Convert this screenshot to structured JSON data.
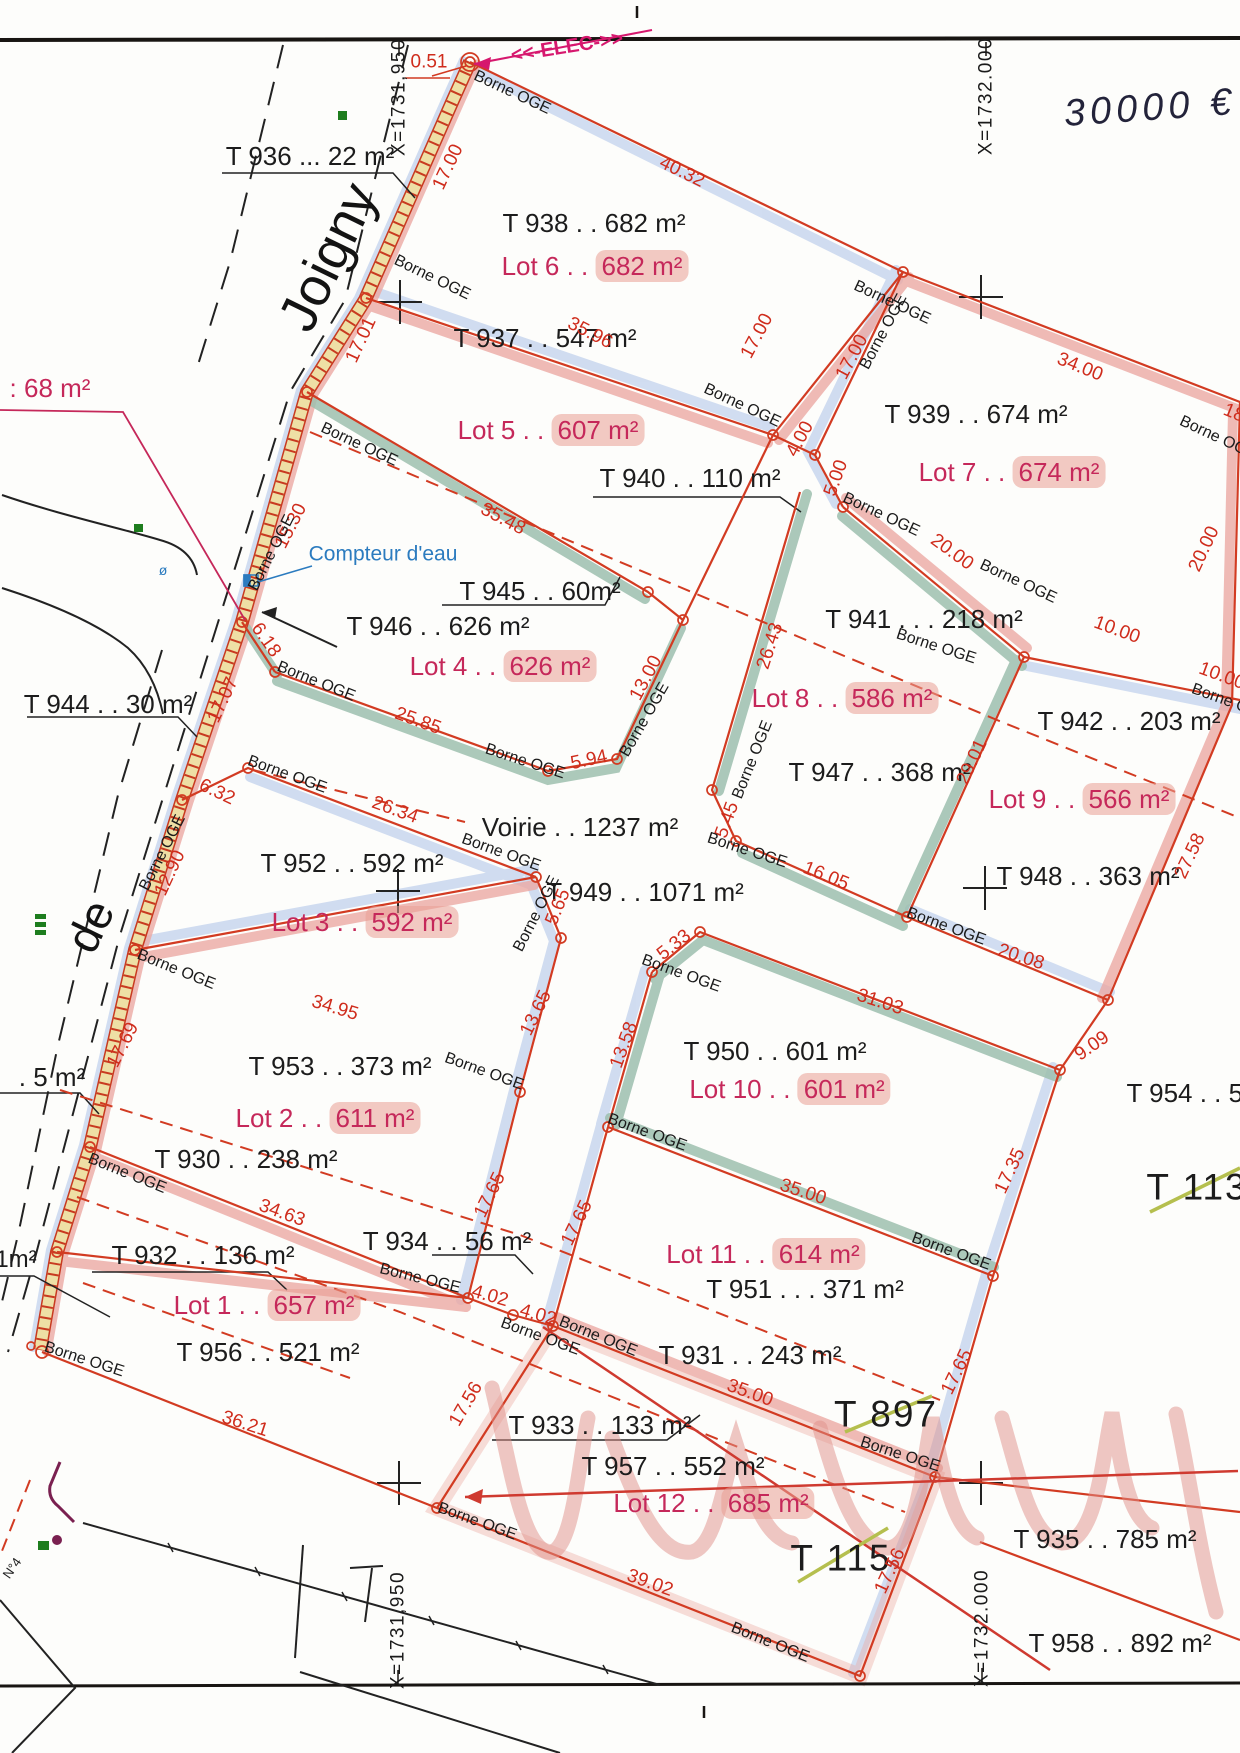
{
  "map": {
    "type": "cadastral subdivision plan",
    "colors": {
      "boundary_red": "#d23b22",
      "measure_red": "#cf2c1c",
      "lot_crimson": "#c5285a",
      "highlight_pink": "#e99e94",
      "band_blue": "#c9d7ef",
      "band_pink": "#eba9a4",
      "band_teal": "#9dbfae",
      "strip_yellow": "#eedfa5",
      "note_blue": "#2b7bbf",
      "elec_magenta": "#d6186e",
      "strike_green": "#b5bf4e",
      "ink_black": "#1c1c1c"
    },
    "borne_marker_text": "Borne OGE"
  },
  "label_groups": [
    {
      "name": "parcel-labels",
      "style": "parcel",
      "items": [
        {
          "n": "T936",
          "t": "T 936 ... 22 m²",
          "x": 310,
          "y": 156
        },
        {
          "n": "T938",
          "t": "T 938  . . 682 m²",
          "x": 594,
          "y": 223
        },
        {
          "n": "T937",
          "t": "T 937 . . 547 m²",
          "x": 545,
          "y": 338
        },
        {
          "n": "T940",
          "t": "T 940 . . 110 m²",
          "x": 690,
          "y": 478
        },
        {
          "n": "T939",
          "t": "T 939 . . 674 m²",
          "x": 976,
          "y": 414
        },
        {
          "n": "T941",
          "t": "T 941 . . . 218 m²",
          "x": 924,
          "y": 619
        },
        {
          "n": "T942",
          "t": "T 942 . . 203 m²",
          "x": 1129,
          "y": 721
        },
        {
          "n": "T947",
          "t": "T 947 . . 368 m²",
          "x": 880,
          "y": 772
        },
        {
          "n": "T948",
          "t": "T 948 . .  363 m²",
          "x": 1088,
          "y": 876
        },
        {
          "n": "T946",
          "t": "T 946 . . 626 m²",
          "x": 438,
          "y": 626
        },
        {
          "n": "T945",
          "t": "T 945 . . 60m²",
          "x": 540,
          "y": 591
        },
        {
          "n": "T944",
          "t": "T 944 . . 30 m²",
          "x": 108,
          "y": 704
        },
        {
          "n": "VOIRIE",
          "t": "Voirie . . 1237 m²",
          "x": 580,
          "y": 827
        },
        {
          "n": "T949",
          "t": "T 949 . .  1071 m²",
          "x": 645,
          "y": 892
        },
        {
          "n": "T952",
          "t": "T 952 . . 592 m²",
          "x": 352,
          "y": 863
        },
        {
          "n": "T953",
          "t": "T 953 . .  373 m²",
          "x": 340,
          "y": 1066
        },
        {
          "n": "T930",
          "t": "T 930 . . 238 m²",
          "x": 246,
          "y": 1159
        },
        {
          "n": "T934",
          "t": "T 934 . . 56 m²",
          "x": 447,
          "y": 1241
        },
        {
          "n": "T932",
          "t": "T 932 . . 136 m²",
          "x": 203,
          "y": 1255
        },
        {
          "n": "T956",
          "t": "T 956 . . 521 m²",
          "x": 268,
          "y": 1352
        },
        {
          "n": "T950",
          "t": "T 950 . . 601 m²",
          "x": 775,
          "y": 1051
        },
        {
          "n": "T951",
          "t": "T 951 . . .  371 m²",
          "x": 805,
          "y": 1289
        },
        {
          "n": "T931",
          "t": "T 931 . . 243 m²",
          "x": 750,
          "y": 1355
        },
        {
          "n": "T933",
          "t": "T 933 . . 133 m²",
          "x": 600,
          "y": 1425
        },
        {
          "n": "T957",
          "t": "T 957 . . 552 m²",
          "x": 673,
          "y": 1466
        },
        {
          "n": "T935",
          "t": "T 935 . . 785 m²",
          "x": 1105,
          "y": 1539
        },
        {
          "n": "T958",
          "t": "T 958 . . 892 m²",
          "x": 1120,
          "y": 1643
        },
        {
          "n": "T954",
          "t": "T 954 . . 58",
          "x": 1192,
          "y": 1093
        }
      ]
    },
    {
      "name": "parcel-labels-large",
      "style": "parcel-big",
      "items": [
        {
          "n": "T897",
          "t": "T 897",
          "x": 886,
          "y": 1414
        },
        {
          "n": "T113",
          "t": "T 113",
          "x": 1197,
          "y": 1187
        },
        {
          "n": "T115",
          "t": "T 115",
          "x": 841,
          "y": 1558
        }
      ]
    },
    {
      "name": "lot-labels",
      "style": "lot",
      "items": [
        {
          "n": "lot-6",
          "prefix": "Lot  6 . .",
          "area": "682 m²",
          "x": 595,
          "y": 266
        },
        {
          "n": "lot-5",
          "prefix": "Lot  5 . .",
          "area": "607 m²",
          "x": 551,
          "y": 430
        },
        {
          "n": "lot-7",
          "prefix": "Lot  7 . .",
          "area": "674 m²",
          "x": 1012,
          "y": 472
        },
        {
          "n": "lot-4",
          "prefix": "Lot  4 . .",
          "area": "626 m²",
          "x": 503,
          "y": 666
        },
        {
          "n": "lot-8",
          "prefix": "Lot  8 . .",
          "area": "586 m²",
          "x": 845,
          "y": 698
        },
        {
          "n": "lot-9",
          "prefix": "Lot  9 . .",
          "area": "566 m²",
          "x": 1082,
          "y": 799
        },
        {
          "n": "lot-3",
          "prefix": "Lot  3 . .",
          "area": "592 m²",
          "x": 365,
          "y": 922
        },
        {
          "n": "lot-2",
          "prefix": "Lot  2 . .",
          "area": "611 m²",
          "x": 328,
          "y": 1118
        },
        {
          "n": "lot-10",
          "prefix": "Lot 10 . .",
          "area": "601 m²",
          "x": 790,
          "y": 1089
        },
        {
          "n": "lot-11",
          "prefix": "Lot 11 . .",
          "area": "614 m²",
          "x": 766,
          "y": 1254
        },
        {
          "n": "lot-1",
          "prefix": "Lot  1 . .",
          "area": "657 m²",
          "x": 267,
          "y": 1305
        },
        {
          "n": "lot-12",
          "prefix": "Lot 12 . .",
          "area": "685 m²",
          "x": 714,
          "y": 1503
        }
      ]
    },
    {
      "name": "measurement-labels",
      "style": "measure",
      "items": [
        {
          "t": "0.51",
          "x": 429,
          "y": 62
        },
        {
          "t": "17.00",
          "x": 448,
          "y": 167,
          "r": -65
        },
        {
          "t": "17.01",
          "x": 361,
          "y": 340,
          "r": -65
        },
        {
          "t": "15.30",
          "x": 291,
          "y": 526,
          "r": -63
        },
        {
          "t": "6.18",
          "x": 266,
          "y": 640,
          "r": 55
        },
        {
          "t": "17.07",
          "x": 223,
          "y": 700,
          "r": -65
        },
        {
          "t": "6.32",
          "x": 217,
          "y": 792,
          "r": 25
        },
        {
          "t": "12.90",
          "x": 170,
          "y": 873,
          "r": -65
        },
        {
          "t": "26.34",
          "x": 395,
          "y": 810,
          "r": 20
        },
        {
          "t": "25.85",
          "x": 418,
          "y": 721,
          "r": 20
        },
        {
          "t": "35.48",
          "x": 503,
          "y": 519,
          "r": 28
        },
        {
          "t": "5.94",
          "x": 589,
          "y": 760,
          "r": -12
        },
        {
          "t": "13.00",
          "x": 646,
          "y": 678,
          "r": -62
        },
        {
          "t": "26.43",
          "x": 770,
          "y": 646,
          "r": -72
        },
        {
          "t": "5.45",
          "x": 727,
          "y": 820,
          "r": -70
        },
        {
          "t": "5.65",
          "x": 558,
          "y": 907,
          "r": -68
        },
        {
          "t": "13.65",
          "x": 536,
          "y": 1013,
          "r": -64
        },
        {
          "t": "5.33",
          "x": 674,
          "y": 945,
          "r": -38
        },
        {
          "t": "16.05",
          "x": 826,
          "y": 876,
          "r": 22
        },
        {
          "t": "20.00",
          "x": 952,
          "y": 552,
          "r": 36
        },
        {
          "t": "20.00",
          "x": 1204,
          "y": 549,
          "r": -65
        },
        {
          "t": "10.00",
          "x": 1117,
          "y": 630,
          "r": 20
        },
        {
          "t": "10.00",
          "x": 1222,
          "y": 676,
          "r": 20
        },
        {
          "t": "34.00",
          "x": 1080,
          "y": 367,
          "r": 22
        },
        {
          "t": "18",
          "x": 1234,
          "y": 413,
          "r": 22
        },
        {
          "t": "5.00",
          "x": 836,
          "y": 478,
          "r": -70
        },
        {
          "t": "4.00",
          "x": 800,
          "y": 439,
          "r": -62
        },
        {
          "t": "17.00",
          "x": 757,
          "y": 336,
          "r": -62
        },
        {
          "t": "17.00",
          "x": 852,
          "y": 357,
          "r": -62
        },
        {
          "t": "40.32",
          "x": 682,
          "y": 172,
          "r": 26
        },
        {
          "t": "35.96",
          "x": 590,
          "y": 333,
          "r": 27
        },
        {
          "t": "34.95",
          "x": 335,
          "y": 1008,
          "r": 17
        },
        {
          "t": "17.69",
          "x": 123,
          "y": 1045,
          "r": -63
        },
        {
          "t": "17.65",
          "x": 490,
          "y": 1195,
          "r": -64
        },
        {
          "t": "17.65",
          "x": 577,
          "y": 1223,
          "r": -64
        },
        {
          "t": "17.65",
          "x": 957,
          "y": 1372,
          "r": -64
        },
        {
          "t": "13.58",
          "x": 624,
          "y": 1045,
          "r": -70
        },
        {
          "t": "31.03",
          "x": 880,
          "y": 1002,
          "r": 18
        },
        {
          "t": "9.09",
          "x": 1092,
          "y": 1046,
          "r": -35
        },
        {
          "t": "20.08",
          "x": 1021,
          "y": 957,
          "r": 18
        },
        {
          "t": "27.58",
          "x": 1190,
          "y": 856,
          "r": -65
        },
        {
          "t": "29.01",
          "x": 972,
          "y": 762,
          "r": -65
        },
        {
          "t": "17.35",
          "x": 1010,
          "y": 1171,
          "r": -65
        },
        {
          "t": "35.00",
          "x": 803,
          "y": 1192,
          "r": 18
        },
        {
          "t": "35.00",
          "x": 750,
          "y": 1393,
          "r": 20
        },
        {
          "t": "4.02",
          "x": 490,
          "y": 1296,
          "r": 16
        },
        {
          "t": "4.02",
          "x": 538,
          "y": 1315,
          "r": 16
        },
        {
          "t": "17.56",
          "x": 466,
          "y": 1404,
          "r": -60
        },
        {
          "t": "17.56",
          "x": 890,
          "y": 1571,
          "r": -65
        },
        {
          "t": "39.02",
          "x": 650,
          "y": 1583,
          "r": 20
        },
        {
          "t": "36.21",
          "x": 245,
          "y": 1424,
          "r": 18
        },
        {
          "t": "34.63",
          "x": 282,
          "y": 1213,
          "r": 20
        }
      ]
    },
    {
      "name": "borne-labels",
      "style": "borne",
      "default_text": "Borne OGE",
      "items": [
        {
          "x": 512,
          "y": 93,
          "r": 25
        },
        {
          "x": 892,
          "y": 303,
          "r": 25
        },
        {
          "x": 884,
          "y": 332,
          "r": -62
        },
        {
          "x": 432,
          "y": 278,
          "r": 26
        },
        {
          "x": 742,
          "y": 406,
          "r": 25
        },
        {
          "x": 359,
          "y": 445,
          "r": 25
        },
        {
          "x": 272,
          "y": 553,
          "r": -63
        },
        {
          "x": 316,
          "y": 682,
          "r": 22
        },
        {
          "x": 287,
          "y": 775,
          "r": 20
        },
        {
          "x": 163,
          "y": 853,
          "r": -63
        },
        {
          "x": 525,
          "y": 762,
          "r": 18
        },
        {
          "x": 645,
          "y": 720,
          "r": -60
        },
        {
          "x": 501,
          "y": 853,
          "r": 20
        },
        {
          "x": 537,
          "y": 914,
          "r": -63
        },
        {
          "x": 747,
          "y": 851,
          "r": 18
        },
        {
          "x": 753,
          "y": 760,
          "r": -68
        },
        {
          "x": 881,
          "y": 515,
          "r": 25
        },
        {
          "x": 1018,
          "y": 582,
          "r": 25
        },
        {
          "x": 936,
          "y": 647,
          "r": 18
        },
        {
          "t": "Borne O",
          "x": 1220,
          "y": 699,
          "r": 20
        },
        {
          "t": "Borne OG",
          "x": 1213,
          "y": 436,
          "r": 25
        },
        {
          "x": 946,
          "y": 927,
          "r": 20
        },
        {
          "x": 176,
          "y": 970,
          "r": 22
        },
        {
          "x": 127,
          "y": 1174,
          "r": 22
        },
        {
          "x": 484,
          "y": 1072,
          "r": 20
        },
        {
          "x": 681,
          "y": 974,
          "r": 20
        },
        {
          "x": 647,
          "y": 1133,
          "r": 20
        },
        {
          "x": 951,
          "y": 1252,
          "r": 20
        },
        {
          "x": 84,
          "y": 1360,
          "r": 18
        },
        {
          "x": 420,
          "y": 1279,
          "r": 14
        },
        {
          "x": 540,
          "y": 1337,
          "r": 20
        },
        {
          "x": 598,
          "y": 1337,
          "r": 22
        },
        {
          "x": 477,
          "y": 1522,
          "r": 20
        },
        {
          "x": 770,
          "y": 1643,
          "r": 22
        },
        {
          "x": 900,
          "y": 1455,
          "r": 18
        }
      ]
    },
    {
      "name": "coordinate-labels",
      "style": "coord",
      "items": [
        {
          "t": "X=1731,950",
          "x": 399,
          "y": 97,
          "r": -90
        },
        {
          "t": "X=1732.000",
          "x": 986,
          "y": 96,
          "r": -90
        },
        {
          "t": "X=1731,950",
          "x": 398,
          "y": 1630,
          "r": -90
        },
        {
          "t": "X=1732.000",
          "x": 982,
          "y": 1628,
          "r": -90
        }
      ]
    },
    {
      "name": "street-labels",
      "style": "street",
      "items": [
        {
          "n": "street-joigny",
          "t": "Joigny",
          "x": 328,
          "y": 257,
          "r": -64,
          "fs": 54
        },
        {
          "n": "street-de",
          "t": "de",
          "x": 90,
          "y": 926,
          "r": -64,
          "fs": 46
        }
      ]
    },
    {
      "name": "misc-labels",
      "style": "misc",
      "items": [
        {
          "n": "area-68",
          "t": ": 68 m²",
          "x": 50,
          "y": 388,
          "fs": 26,
          "c": "#c5285a"
        },
        {
          "n": "area-5",
          "t": ". 5 m²",
          "x": 52,
          "y": 1077,
          "fs": 26,
          "c": "#1c1c1c"
        },
        {
          "n": "area-1",
          "t": "1m²",
          "x": 16,
          "y": 1260,
          "fs": 24,
          "c": "#1c1c1c"
        },
        {
          "n": "no4",
          "t": "N°4",
          "x": 12,
          "y": 1568,
          "r": -55,
          "fs": 13,
          "c": "#1c1c1c"
        },
        {
          "n": "price-note",
          "t": "30000 €",
          "x": 1150,
          "y": 108,
          "r": -4,
          "fs": 38,
          "c": "#23233a",
          "cls": "hand"
        },
        {
          "n": "elec-note",
          "t": "<<-ELEC->>",
          "x": 567,
          "y": 47,
          "r": -9,
          "fs": 20,
          "c": "#d6186e",
          "b": 1
        },
        {
          "n": "water-meter-note",
          "t": "Compteur d'eau",
          "x": 383,
          "y": 554,
          "fs": 21,
          "c": "#2b7bbf"
        },
        {
          "n": "valve-symbol",
          "t": "ø",
          "x": 163,
          "y": 570,
          "fs": 14,
          "c": "#2b7bbf"
        }
      ]
    }
  ]
}
